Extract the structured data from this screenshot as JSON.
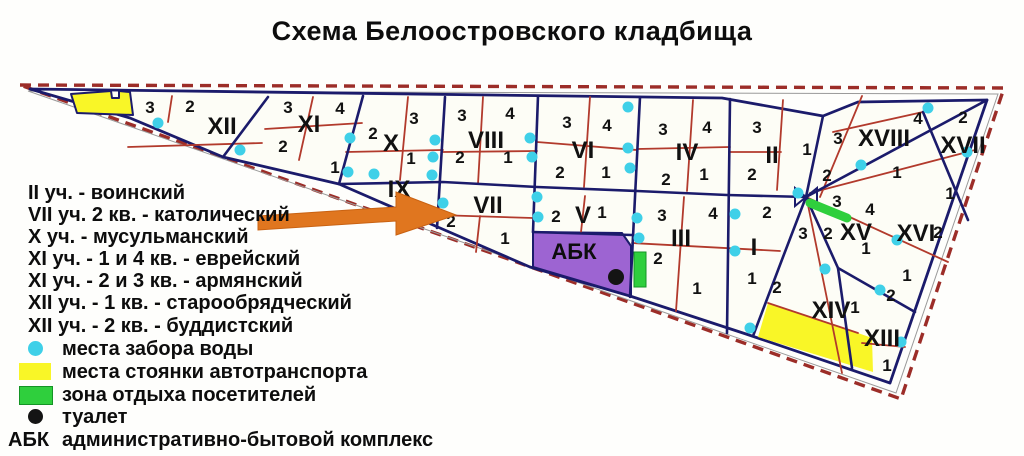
{
  "title": "Схема Белоостровского кладбища",
  "colors": {
    "border_dashed": "#9c2d28",
    "section_line": "#1b1b6b",
    "quarter_line": "#b23a2c",
    "water_point": "#3fd0e8",
    "parking": "#f9f627",
    "recreation": "#2fcf3d",
    "abk_zone": "#9d64d2",
    "arrow": "#e0761f"
  },
  "legend": {
    "items": [
      {
        "label": "II уч. - воинский",
        "icon": "none",
        "y": 193
      },
      {
        "label": "VII уч. 2 кв. - католический",
        "icon": "none",
        "y": 215
      },
      {
        "label": "X уч. - мусульманский",
        "icon": "none",
        "y": 237
      },
      {
        "label": "XI уч. - 1 и 4 кв. - еврейский",
        "icon": "none",
        "y": 259
      },
      {
        "label": "XI уч. - 2 и 3 кв. - армянский",
        "icon": "none",
        "y": 281
      },
      {
        "label": "XII уч. - 1 кв. - старообрядческий",
        "icon": "none",
        "y": 303
      },
      {
        "label": "XII уч. - 2 кв. - буддистский",
        "icon": "none",
        "y": 326
      },
      {
        "label": "места забора воды",
        "icon": "water",
        "y": 349
      },
      {
        "label": "места стоянки автотранспорта",
        "icon": "parking",
        "y": 372
      },
      {
        "label": "зона отдыха посетителей",
        "icon": "recreation",
        "y": 395
      },
      {
        "label": "туалет",
        "icon": "toilet",
        "y": 417
      },
      {
        "label": "административно-бытовой комплекс",
        "icon": "abk",
        "y": 440,
        "prefix": "АБК"
      }
    ]
  },
  "map": {
    "abk_label": "АБК",
    "abk_label_pos": [
      574,
      259
    ],
    "sections": [
      {
        "name": "XII",
        "x": 222,
        "y": 134
      },
      {
        "name": "XI",
        "x": 309,
        "y": 132
      },
      {
        "name": "X",
        "x": 391,
        "y": 151
      },
      {
        "name": "IX",
        "x": 399,
        "y": 197
      },
      {
        "name": "VIII",
        "x": 486,
        "y": 148
      },
      {
        "name": "VII",
        "x": 488,
        "y": 213
      },
      {
        "name": "VI",
        "x": 583,
        "y": 158
      },
      {
        "name": "V",
        "x": 583,
        "y": 223
      },
      {
        "name": "IV",
        "x": 687,
        "y": 160
      },
      {
        "name": "III",
        "x": 681,
        "y": 246
      },
      {
        "name": "II",
        "x": 772,
        "y": 163
      },
      {
        "name": "I",
        "x": 754,
        "y": 255
      },
      {
        "name": "XVIII",
        "x": 884,
        "y": 146
      },
      {
        "name": "XVII",
        "x": 963,
        "y": 153
      },
      {
        "name": "XV",
        "x": 856,
        "y": 240
      },
      {
        "name": "XVI",
        "x": 916,
        "y": 241
      },
      {
        "name": "XIV",
        "x": 831,
        "y": 318
      },
      {
        "name": "XIII",
        "x": 882,
        "y": 346
      }
    ],
    "quarters": [
      {
        "n": "3",
        "x": 150,
        "y": 113
      },
      {
        "n": "2",
        "x": 190,
        "y": 112
      },
      {
        "n": "3",
        "x": 288,
        "y": 113
      },
      {
        "n": "4",
        "x": 340,
        "y": 114
      },
      {
        "n": "2",
        "x": 283,
        "y": 152
      },
      {
        "n": "1",
        "x": 335,
        "y": 173
      },
      {
        "n": "2",
        "x": 373,
        "y": 139
      },
      {
        "n": "3",
        "x": 414,
        "y": 124
      },
      {
        "n": "1",
        "x": 411,
        "y": 164
      },
      {
        "n": "3",
        "x": 462,
        "y": 121
      },
      {
        "n": "4",
        "x": 510,
        "y": 119
      },
      {
        "n": "2",
        "x": 460,
        "y": 163
      },
      {
        "n": "1",
        "x": 508,
        "y": 163
      },
      {
        "n": "3",
        "x": 567,
        "y": 128
      },
      {
        "n": "4",
        "x": 607,
        "y": 131
      },
      {
        "n": "2",
        "x": 560,
        "y": 178
      },
      {
        "n": "1",
        "x": 606,
        "y": 178
      },
      {
        "n": "3",
        "x": 663,
        "y": 135
      },
      {
        "n": "4",
        "x": 707,
        "y": 133
      },
      {
        "n": "2",
        "x": 666,
        "y": 185
      },
      {
        "n": "1",
        "x": 704,
        "y": 180
      },
      {
        "n": "3",
        "x": 757,
        "y": 133
      },
      {
        "n": "1",
        "x": 807,
        "y": 155
      },
      {
        "n": "2",
        "x": 752,
        "y": 180
      },
      {
        "n": "2",
        "x": 451,
        "y": 227
      },
      {
        "n": "1",
        "x": 505,
        "y": 244
      },
      {
        "n": "2",
        "x": 556,
        "y": 222
      },
      {
        "n": "1",
        "x": 602,
        "y": 218
      },
      {
        "n": "3",
        "x": 662,
        "y": 221
      },
      {
        "n": "4",
        "x": 713,
        "y": 219
      },
      {
        "n": "2",
        "x": 658,
        "y": 264
      },
      {
        "n": "1",
        "x": 697,
        "y": 294
      },
      {
        "n": "2",
        "x": 767,
        "y": 218
      },
      {
        "n": "1",
        "x": 752,
        "y": 284
      },
      {
        "n": "3",
        "x": 838,
        "y": 144
      },
      {
        "n": "4",
        "x": 918,
        "y": 124
      },
      {
        "n": "2",
        "x": 827,
        "y": 181
      },
      {
        "n": "1",
        "x": 897,
        "y": 178
      },
      {
        "n": "2",
        "x": 963,
        "y": 123
      },
      {
        "n": "1",
        "x": 950,
        "y": 199
      },
      {
        "n": "3",
        "x": 837,
        "y": 207
      },
      {
        "n": "4",
        "x": 870,
        "y": 215
      },
      {
        "n": "1",
        "x": 866,
        "y": 254
      },
      {
        "n": "2",
        "x": 938,
        "y": 238
      },
      {
        "n": "1",
        "x": 907,
        "y": 281
      },
      {
        "n": "3",
        "x": 803,
        "y": 239
      },
      {
        "n": "2",
        "x": 828,
        "y": 239
      },
      {
        "n": "2",
        "x": 777,
        "y": 293
      },
      {
        "n": "1",
        "x": 855,
        "y": 313
      },
      {
        "n": "2",
        "x": 891,
        "y": 301
      },
      {
        "n": "1",
        "x": 887,
        "y": 371
      }
    ],
    "water_points": [
      [
        158,
        123
      ],
      [
        240,
        150
      ],
      [
        350,
        138
      ],
      [
        348,
        172
      ],
      [
        374,
        174
      ],
      [
        435,
        140
      ],
      [
        433,
        157
      ],
      [
        432,
        175
      ],
      [
        443,
        203
      ],
      [
        530,
        138
      ],
      [
        532,
        157
      ],
      [
        537,
        197
      ],
      [
        538,
        217
      ],
      [
        628,
        107
      ],
      [
        628,
        148
      ],
      [
        630,
        168
      ],
      [
        637,
        218
      ],
      [
        639,
        238
      ],
      [
        735,
        214
      ],
      [
        735,
        251
      ],
      [
        750,
        328
      ],
      [
        798,
        193
      ],
      [
        861,
        165
      ],
      [
        928,
        108
      ],
      [
        967,
        152
      ],
      [
        825,
        269
      ],
      [
        880,
        290
      ],
      [
        897,
        240
      ],
      [
        901,
        342
      ]
    ],
    "toilet_point": [
      616,
      277
    ]
  }
}
